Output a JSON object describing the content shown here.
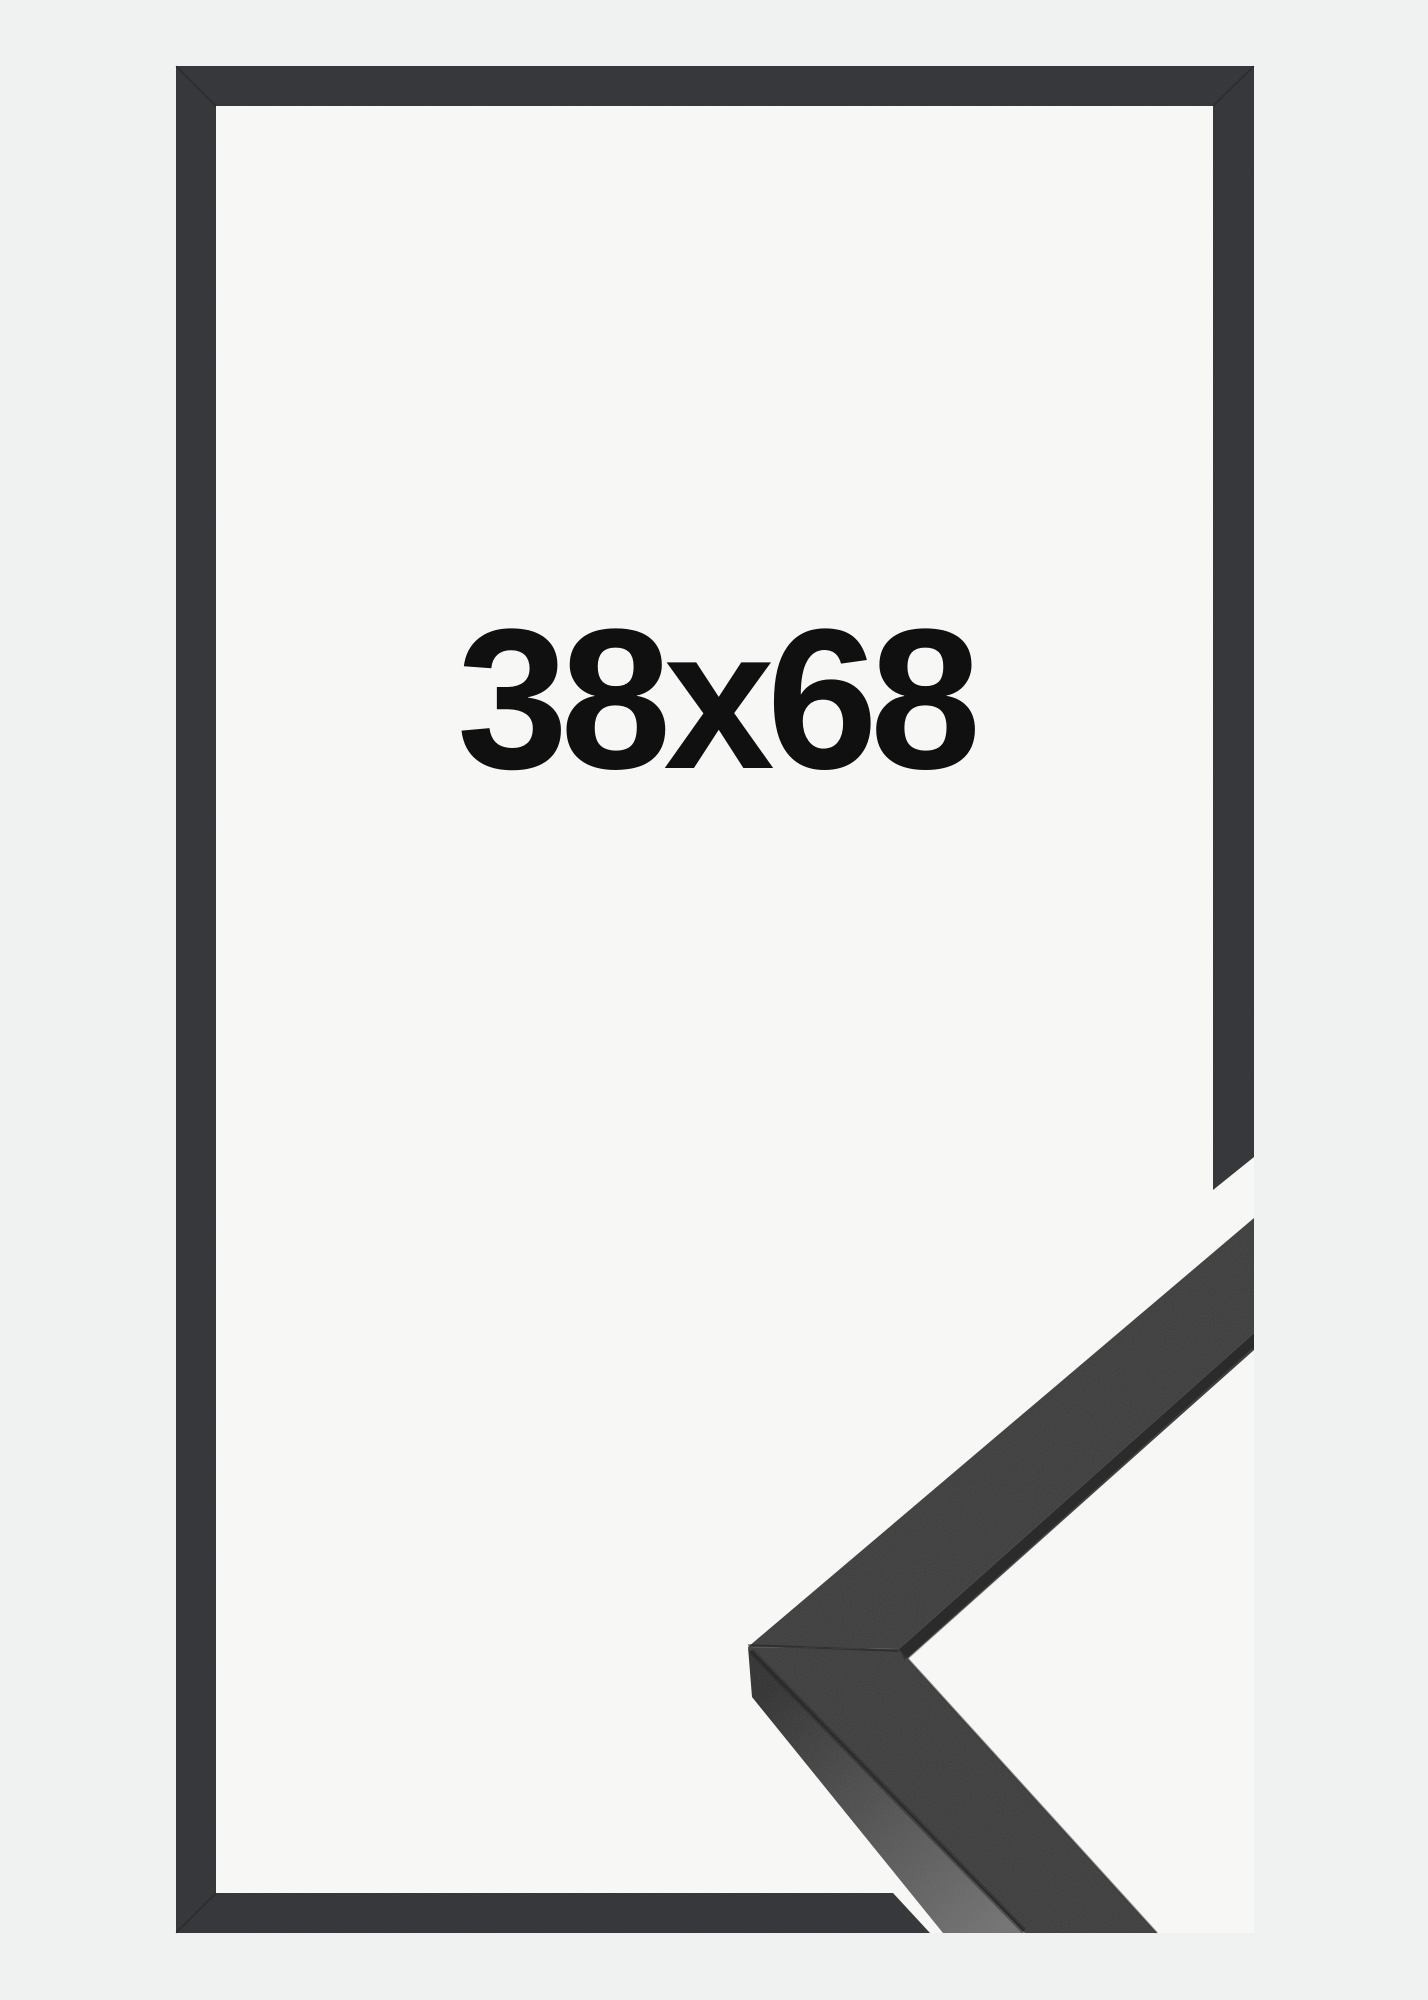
{
  "frame_preview": {
    "size_label": "38x68"
  },
  "colors": {
    "bg": "#f0f1f1",
    "plate": "#f7f7f6",
    "frame": "#333538",
    "mold": "#3a3a3a",
    "moldDark": "#2b2b2b",
    "sideA": "#2f2f2f",
    "sideB": "#707070",
    "crease": "#1c1c1c",
    "seam": "#0d0d0d",
    "hairline": "#626262",
    "text": "#101010"
  }
}
